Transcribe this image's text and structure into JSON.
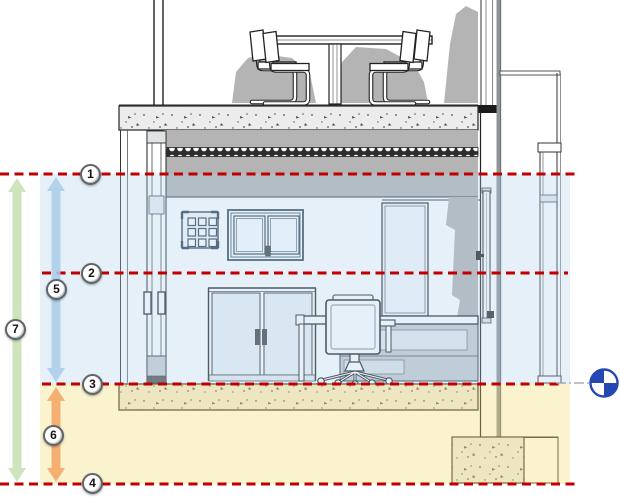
{
  "page": {
    "type": "architectural-section-view"
  },
  "drawing": {
    "level_markers": [
      {
        "label": "1"
      },
      {
        "label": "2"
      },
      {
        "label": "3"
      },
      {
        "label": "4"
      }
    ],
    "dimension_markers": [
      {
        "label": "5",
        "color": "#a9cde9",
        "spans": "level-1-to-level-3"
      },
      {
        "label": "6",
        "color": "#f4a263",
        "spans": "level-3-to-level-4"
      },
      {
        "label": "7",
        "color": "#c4dfb2",
        "spans": "level-1-to-level-4"
      }
    ],
    "colors": {
      "level_line_red": "#c00000",
      "upper_zone_blue": "#aecfec",
      "lower_zone_yellow": "#f1dc74",
      "poche_gray": "#b4b4b4",
      "base_point_blue": "#2547b2",
      "extension_line_gray": "#9aa0a5"
    },
    "symbols": {
      "base_point": "project-base-point"
    }
  }
}
